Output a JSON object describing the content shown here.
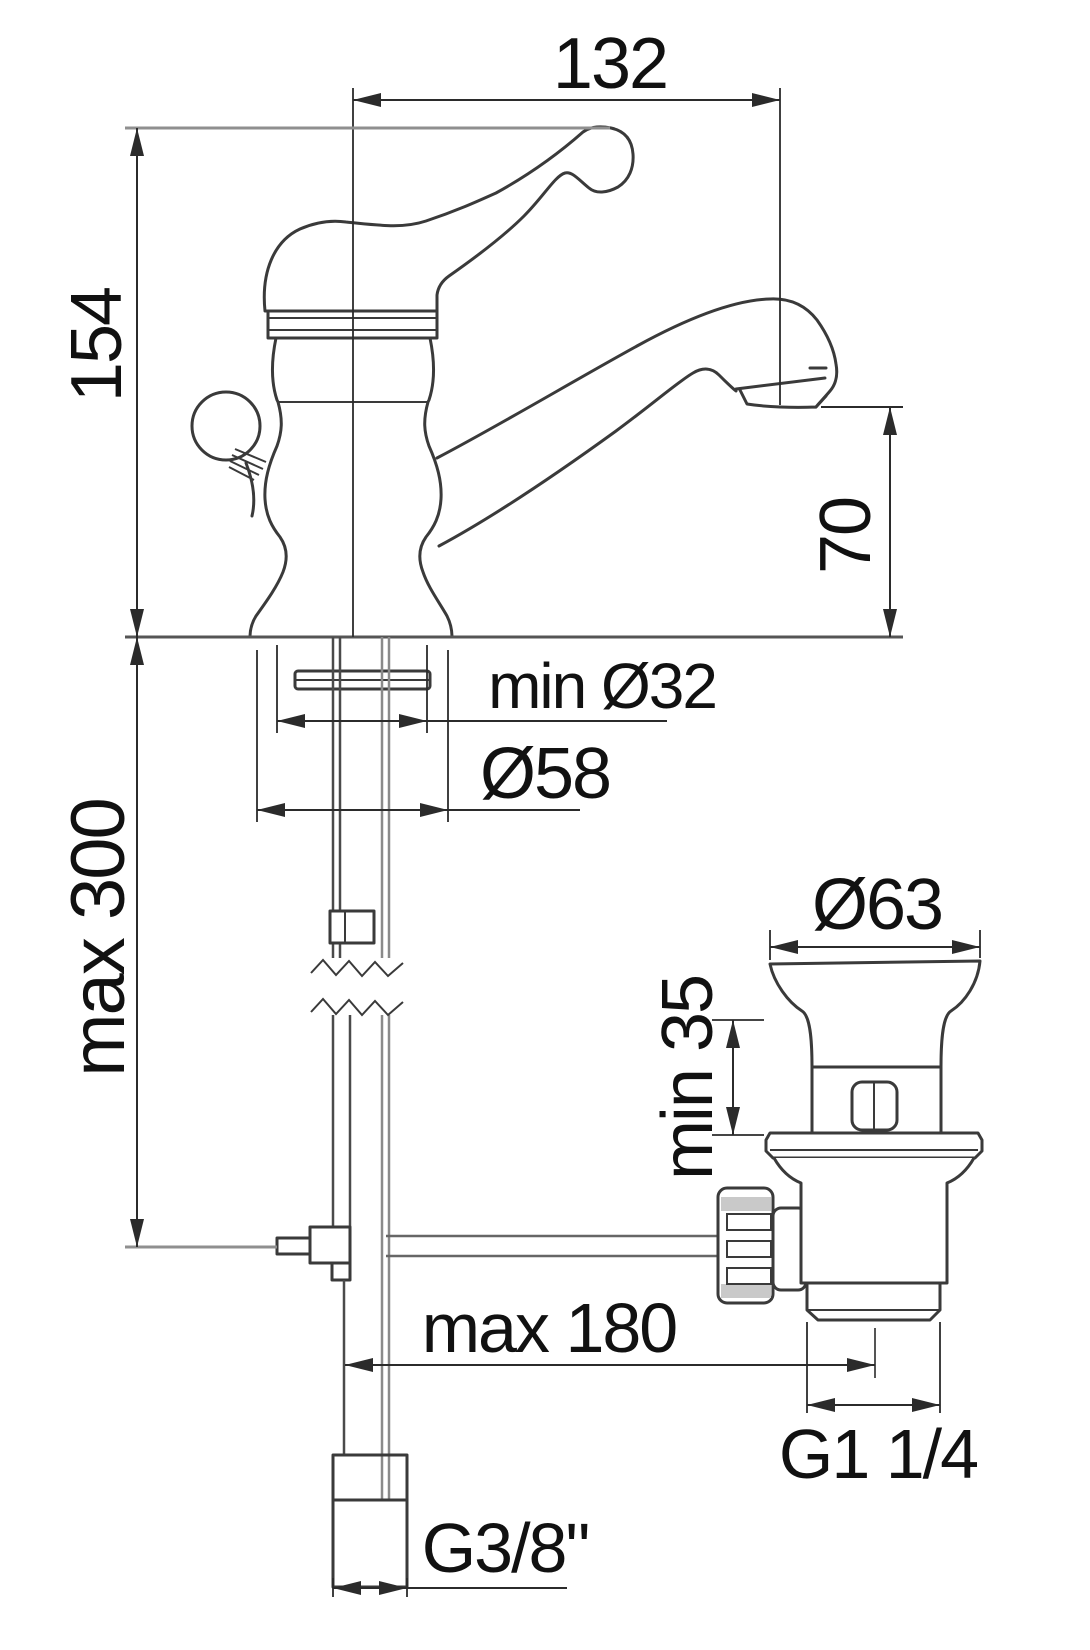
{
  "colors": {
    "background": "#ffffff",
    "drawing_line": "#3a3a3a",
    "dimension_line": "#2b2b2b",
    "reference_line": "#8f8f8f",
    "text": "#111111"
  },
  "dimensions": {
    "spout_projection": {
      "value": "132"
    },
    "total_height": {
      "value": "154"
    },
    "spout_outlet_height": {
      "value": "70"
    },
    "mounting_hole_min": {
      "value": "min Ø32"
    },
    "base_diameter": {
      "value": "Ø58"
    },
    "supply_max_length": {
      "value": "max 300"
    },
    "waste_flange_diameter": {
      "value": "Ø63"
    },
    "deck_min_thickness": {
      "value": "min 35"
    },
    "rod_max_reach": {
      "value": "max 180"
    },
    "waste_thread": {
      "value": "G1 1/4"
    },
    "supply_thread": {
      "value": "G3/8\""
    }
  }
}
